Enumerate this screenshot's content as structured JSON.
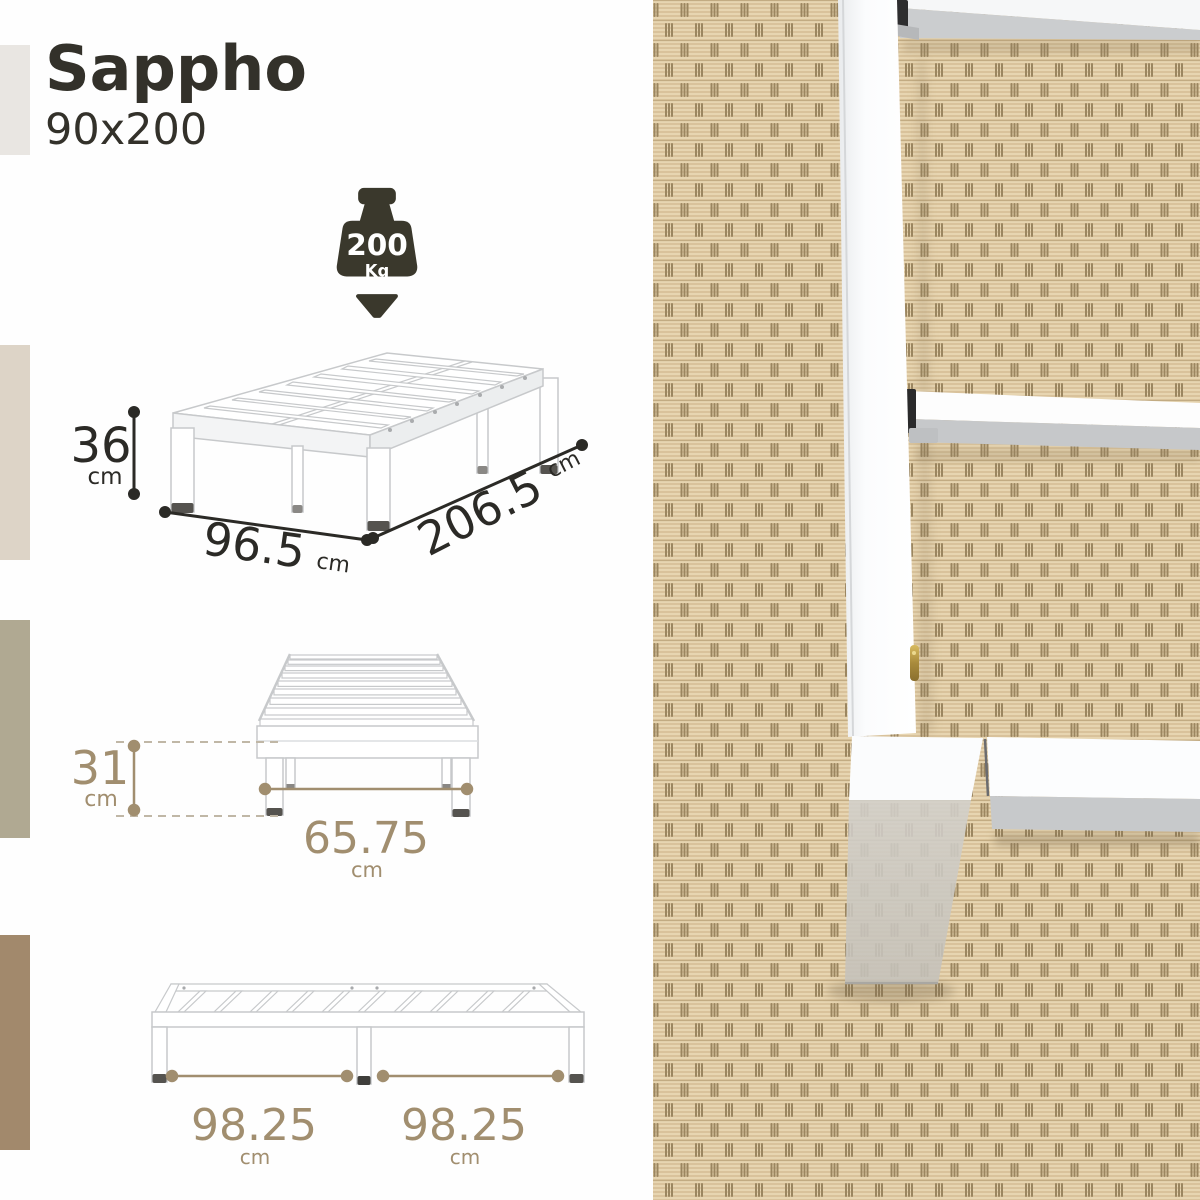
{
  "header": {
    "title": "Sappho",
    "size": "90x200"
  },
  "capacity": {
    "value": "200",
    "unit": "Kg"
  },
  "dimensions": {
    "iso_height": {
      "value": "36",
      "unit": "cm"
    },
    "iso_width": {
      "value": "96.5",
      "unit": "cm"
    },
    "iso_length": {
      "value": "206.5",
      "unit": "cm"
    },
    "side_height": {
      "value": "31",
      "unit": "cm"
    },
    "side_span": {
      "value": "65.75",
      "unit": "cm"
    },
    "front_left_span": {
      "value": "98.25",
      "unit": "cm"
    },
    "front_right_span": {
      "value": "98.25",
      "unit": "cm"
    }
  },
  "icons": {
    "capacity": "weight-kettlebell-icon",
    "pointer": "down-arrow-icon"
  },
  "colors": {
    "ink": "#2b2a26",
    "tan": "#a18e6f",
    "stripes": [
      "#e9e6e2",
      "#ddd4c7",
      "#b0a992",
      "#a2896c"
    ],
    "carpet_base": "#d7c098",
    "carpet_rope": "#e7d5b1",
    "carpet_seam": "#9b8660",
    "frame_white": "#ffffff",
    "frame_shade": "#c9c7c2"
  }
}
